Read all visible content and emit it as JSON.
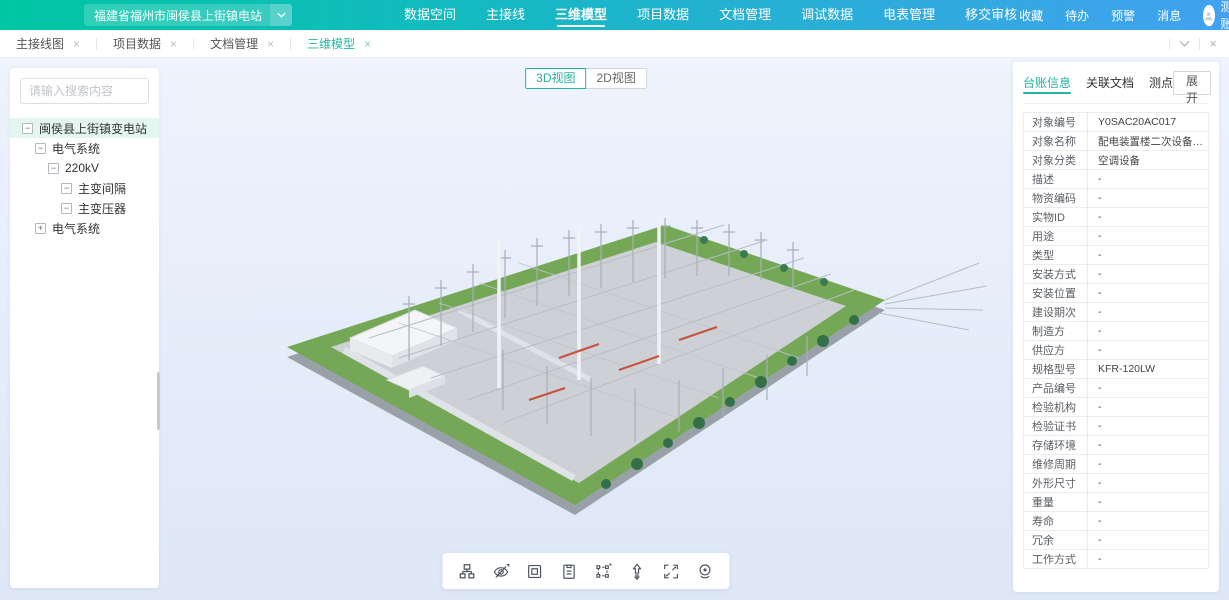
{
  "colors": {
    "accent_teal": "#26b3a0",
    "header_gradient_start": "#00c7a3",
    "header_gradient_end": "#42a1f1",
    "tree_selection_bg": "#e4f6f0"
  },
  "header": {
    "station_selector": "福建省福州市闽侯县上街镇电站",
    "nav_items": [
      {
        "label": "数据空间",
        "active": false
      },
      {
        "label": "主接线",
        "active": false
      },
      {
        "label": "三维模型",
        "active": true
      },
      {
        "label": "项目数据",
        "active": false
      },
      {
        "label": "文档管理",
        "active": false
      },
      {
        "label": "调试数据",
        "active": false
      },
      {
        "label": "电表管理",
        "active": false
      },
      {
        "label": "移交审核",
        "active": false
      }
    ],
    "quick_links": [
      "收藏",
      "待办",
      "预警",
      "消息"
    ],
    "account_name": "测试账号"
  },
  "tab_bar": {
    "close_glyph": "×",
    "tabs": [
      {
        "label": "主接线图",
        "active": false
      },
      {
        "label": "项目数据",
        "active": false
      },
      {
        "label": "文档管理",
        "active": false
      },
      {
        "label": "三维模型",
        "active": true
      }
    ]
  },
  "sidebar": {
    "search_placeholder": "请输入搜索内容",
    "tree": [
      {
        "label": "闽侯县上街镇变电站",
        "depth": 0,
        "expander": "minus",
        "selected": true
      },
      {
        "label": "电气系统",
        "depth": 1,
        "expander": "minus",
        "selected": false
      },
      {
        "label": "220kV",
        "depth": 2,
        "expander": "minus",
        "selected": false
      },
      {
        "label": "主变间隔",
        "depth": 3,
        "expander": "minus",
        "selected": false
      },
      {
        "label": "主变压器",
        "depth": 3,
        "expander": "minus",
        "selected": false
      },
      {
        "label": "电气系统",
        "depth": 1,
        "expander": "plus",
        "selected": false
      }
    ]
  },
  "viewport": {
    "view_buttons": [
      {
        "label": "3D视图",
        "active": true
      },
      {
        "label": "2D视图",
        "active": false
      }
    ],
    "toolbar_icons": [
      "model-tree-icon",
      "hide-icon",
      "frame-icon",
      "clipboard-icon",
      "box-select-icon",
      "elevation-icon",
      "fullscreen-icon",
      "viewpoint-icon"
    ]
  },
  "detail_panel": {
    "tabs": [
      {
        "label": "台账信息",
        "active": true
      },
      {
        "label": "关联文档",
        "active": false
      },
      {
        "label": "测点",
        "active": false
      }
    ],
    "expand_button": "展开",
    "rows": [
      {
        "label": "对象编号",
        "value": "Y0SAC20AC017"
      },
      {
        "label": "对象名称",
        "value": "配电装置楼二次设备室柜式空..."
      },
      {
        "label": "对象分类",
        "value": "空调设备"
      },
      {
        "label": "描述",
        "value": "-"
      },
      {
        "label": "物资编码",
        "value": "-"
      },
      {
        "label": "实物ID",
        "value": "-"
      },
      {
        "label": "用途",
        "value": "-"
      },
      {
        "label": "类型",
        "value": "-"
      },
      {
        "label": "安装方式",
        "value": "-"
      },
      {
        "label": "安装位置",
        "value": "-"
      },
      {
        "label": "建设期次",
        "value": "-"
      },
      {
        "label": "制造方",
        "value": "-"
      },
      {
        "label": "供应方",
        "value": "-"
      },
      {
        "label": "规格型号",
        "value": "KFR-120LW"
      },
      {
        "label": "产品编号",
        "value": "-"
      },
      {
        "label": "检验机构",
        "value": "-"
      },
      {
        "label": "检验证书",
        "value": "-"
      },
      {
        "label": "存储环境",
        "value": "-"
      },
      {
        "label": "维修周期",
        "value": "-"
      },
      {
        "label": "外形尺寸",
        "value": "-"
      },
      {
        "label": "重量",
        "value": "-"
      },
      {
        "label": "寿命",
        "value": "-"
      },
      {
        "label": "冗余",
        "value": "-"
      },
      {
        "label": "工作方式",
        "value": "-"
      }
    ]
  }
}
